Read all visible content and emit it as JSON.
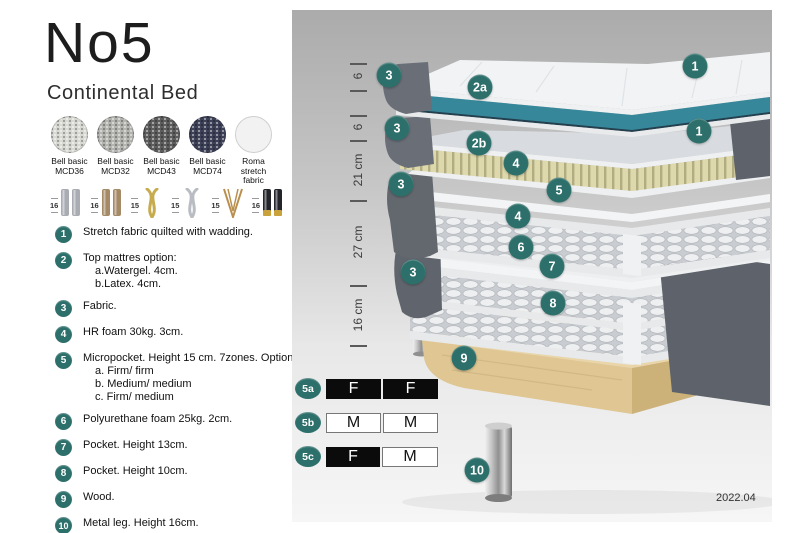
{
  "product": {
    "title": "No5",
    "subtitle": "Continental Bed"
  },
  "fabric_swatches": [
    {
      "line1": "Bell basic",
      "line2": "MCD36",
      "color": "#d9d9d4",
      "texture": "woven"
    },
    {
      "line1": "Bell basic",
      "line2": "MCD32",
      "color": "#b3b3b0",
      "texture": "woven"
    },
    {
      "line1": "Bell basic",
      "line2": "MCD43",
      "color": "#5d5d5d",
      "texture": "woven"
    },
    {
      "line1": "Bell basic",
      "line2": "MCD74",
      "color": "#3d4157",
      "texture": "woven"
    },
    {
      "line1": "Roma",
      "line2": "stretch fabric",
      "color": "#f2f2f2",
      "texture": "plain"
    }
  ],
  "leg_options": [
    {
      "size": "16",
      "type": "cylinder",
      "color": "#a9adb3"
    },
    {
      "size": "16",
      "type": "cylinder",
      "color": "#a58a68"
    },
    {
      "size": "15",
      "type": "twisted",
      "color": "#c6ab4f"
    },
    {
      "size": "15",
      "type": "twisted",
      "color": "#b9bdc3"
    },
    {
      "size": "15",
      "type": "hairpin",
      "color": "#b98f4e"
    },
    {
      "size": "16",
      "type": "cylinder-capped",
      "color": "#23252b",
      "accent": "#c9a23c"
    }
  ],
  "legend": {
    "items": [
      {
        "num": "1",
        "text": "Stretch fabric quilted with wadding.",
        "sub": []
      },
      {
        "num": "2",
        "text": "Top mattres option:",
        "sub": [
          "a.Watergel. 4cm.",
          "b.Latex. 4cm."
        ]
      },
      {
        "num": "3",
        "text": "Fabric.",
        "sub": []
      },
      {
        "num": "4",
        "text": "HR foam 30kg. 3cm.",
        "sub": []
      },
      {
        "num": "5",
        "text": "Micropocket. Height 15 cm. 7zones. Option:",
        "sub": [
          "a. Firm/ firm",
          "b. Medium/ medium",
          "c. Firm/ medium"
        ]
      },
      {
        "num": "6",
        "text": "Polyurethane foam 25kg. 2cm.",
        "sub": []
      },
      {
        "num": "7",
        "text": "Pocket. Height 13cm.",
        "sub": []
      },
      {
        "num": "8",
        "text": "Pocket. Height 10cm.",
        "sub": []
      },
      {
        "num": "9",
        "text": "Wood.",
        "sub": []
      },
      {
        "num": "10",
        "text": "Metal leg. Height 16cm.",
        "sub": []
      }
    ]
  },
  "diagram": {
    "measurements": {
      "ticks_y": [
        53,
        80,
        105,
        130,
        190,
        275,
        335
      ],
      "labels": [
        {
          "text": "6",
          "y": 66
        },
        {
          "text": "6",
          "y": 117
        },
        {
          "text": "21 cm",
          "y": 160
        },
        {
          "text": "27 cm",
          "y": 232
        },
        {
          "text": "16 cm",
          "y": 305
        }
      ]
    },
    "callouts": [
      {
        "label": "1",
        "x": 403,
        "y": 56
      },
      {
        "label": "3",
        "x": 97,
        "y": 65
      },
      {
        "label": "2a",
        "x": 188,
        "y": 77
      },
      {
        "label": "3",
        "x": 105,
        "y": 118
      },
      {
        "label": "1",
        "x": 407,
        "y": 121
      },
      {
        "label": "2b",
        "x": 187,
        "y": 133
      },
      {
        "label": "4",
        "x": 224,
        "y": 153
      },
      {
        "label": "3",
        "x": 109,
        "y": 174
      },
      {
        "label": "5",
        "x": 267,
        "y": 180
      },
      {
        "label": "4",
        "x": 226,
        "y": 206
      },
      {
        "label": "6",
        "x": 229,
        "y": 237
      },
      {
        "label": "7",
        "x": 260,
        "y": 256
      },
      {
        "label": "3",
        "x": 121,
        "y": 262
      },
      {
        "label": "8",
        "x": 261,
        "y": 293
      },
      {
        "label": "9",
        "x": 172,
        "y": 348
      },
      {
        "label": "10",
        "x": 185,
        "y": 460
      }
    ]
  },
  "size_table": {
    "rows": [
      {
        "label": "5a",
        "y": 368,
        "cells": [
          {
            "text": "F",
            "variant": "dark"
          },
          {
            "text": "F",
            "variant": "dark"
          }
        ]
      },
      {
        "label": "5b",
        "y": 402,
        "cells": [
          {
            "text": "M",
            "variant": "light"
          },
          {
            "text": "M",
            "variant": "light"
          }
        ]
      },
      {
        "label": "5c",
        "y": 436,
        "cells": [
          {
            "text": "F",
            "variant": "dark"
          },
          {
            "text": "M",
            "variant": "light"
          }
        ]
      }
    ]
  },
  "version": "2022.04",
  "colors": {
    "accent_teal": "#2d6f6a",
    "layer_teal": "#37879b",
    "fabric_gray": "#686d76",
    "slat_cream": "#ded9ac",
    "wood": "#e9d5a8",
    "table_dark": "#0b0b0b"
  }
}
